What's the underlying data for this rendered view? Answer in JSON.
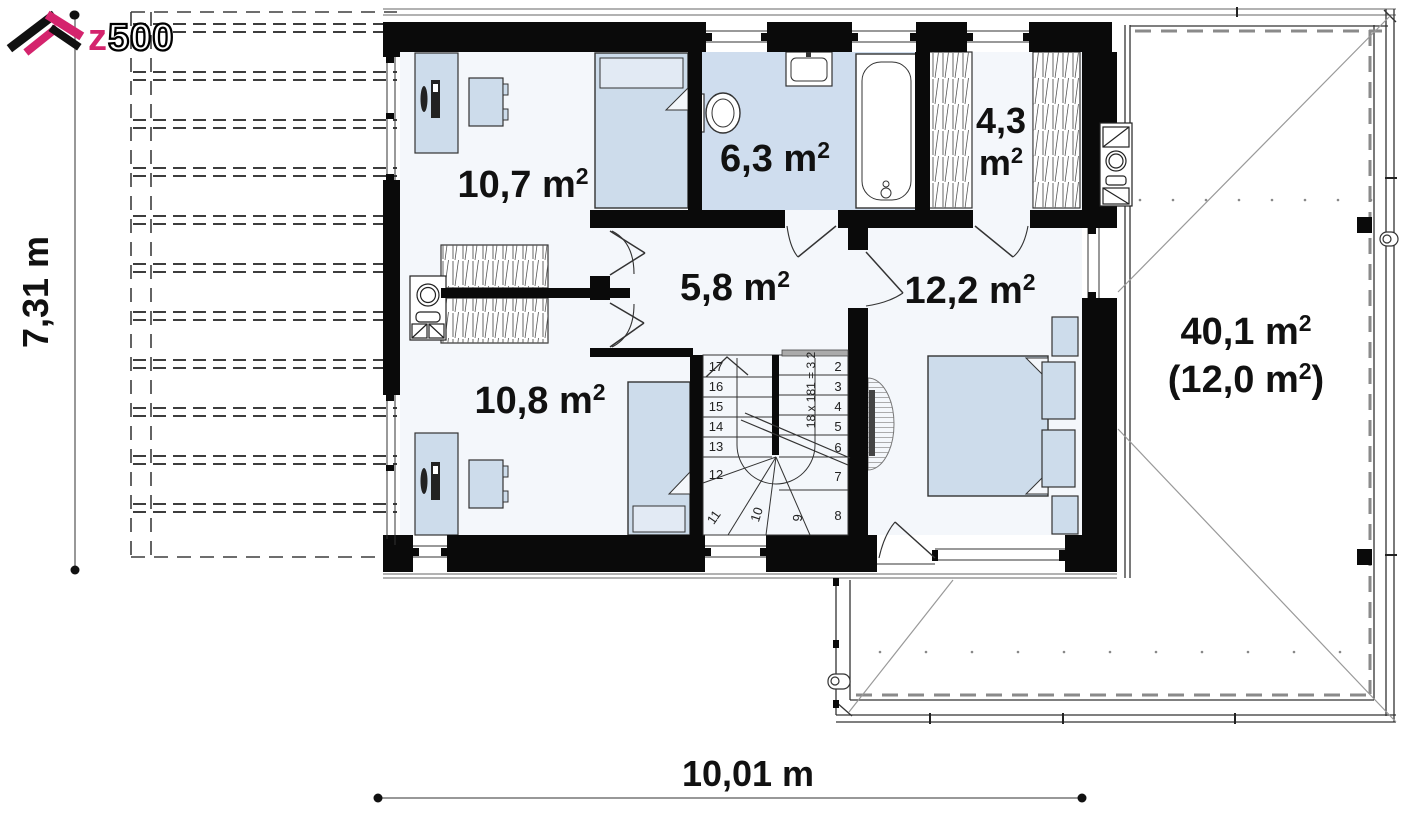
{
  "logo": {
    "z": "z",
    "rest": "500"
  },
  "dimensions": {
    "height": "7,31 m",
    "width": "10,01 m"
  },
  "rooms": {
    "bedroom_top_left": {
      "label": "10,7 m",
      "sup": "2"
    },
    "bathroom": {
      "label": "6,3 m",
      "sup": "2"
    },
    "wardrobe": {
      "line1": "4,3",
      "line2": "m",
      "sup": "2"
    },
    "hall": {
      "label": "5,8 m",
      "sup": "2"
    },
    "bedroom_right": {
      "label": "12,2 m",
      "sup": "2"
    },
    "bedroom_bottom_left": {
      "label": "10,8 m",
      "sup": "2"
    },
    "attic": {
      "line1": "40,1 m",
      "line1_sup": "2",
      "line2_a": "(12,0 m",
      "line2_sup": "2",
      "line2_b": ")"
    }
  },
  "stairs": {
    "note": "18 x 181 = 3 2",
    "steps": [
      "17",
      "16",
      "15",
      "14",
      "13",
      "12",
      "11",
      "10",
      "9",
      "8",
      "7",
      "6",
      "5",
      "4",
      "3",
      "2"
    ]
  }
}
